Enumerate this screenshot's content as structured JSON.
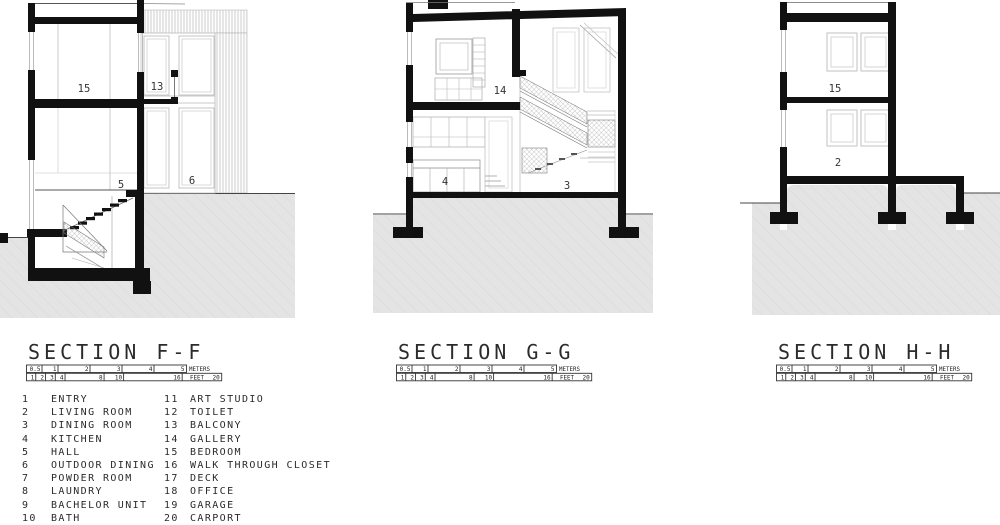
{
  "colors": {
    "ink": "#111111",
    "ground": "#e4e4e4",
    "ground_hatch": "#d8d8d8",
    "thin_line": "#9a9a9a",
    "frame": "#bbbbbb",
    "text": "#2b2b2b"
  },
  "sections": [
    {
      "id": "ff",
      "title": "SECTION F-F",
      "labels": {
        "bedroom": "15",
        "balcony": "13",
        "hall": "5",
        "outdoor_dining": "6"
      }
    },
    {
      "id": "gg",
      "title": "SECTION G-G",
      "labels": {
        "gallery": "14",
        "kitchen": "4",
        "dining_room": "3"
      }
    },
    {
      "id": "hh",
      "title": "SECTION H-H",
      "labels": {
        "bedroom": "15",
        "living_room": "2"
      }
    }
  ],
  "scalebar": {
    "meters_unit": "METERS",
    "feet_unit": "FEET",
    "meters": [
      0.5,
      1,
      2,
      3,
      4,
      5
    ],
    "feet": [
      1,
      2,
      3,
      4,
      8,
      10,
      16,
      20
    ]
  },
  "legend": {
    "left": [
      {
        "num": "1",
        "name": "ENTRY"
      },
      {
        "num": "2",
        "name": "LIVING ROOM"
      },
      {
        "num": "3",
        "name": "DINING ROOM"
      },
      {
        "num": "4",
        "name": "KITCHEN"
      },
      {
        "num": "5",
        "name": "HALL"
      },
      {
        "num": "6",
        "name": "OUTDOOR DINING"
      },
      {
        "num": "7",
        "name": "POWDER ROOM"
      },
      {
        "num": "8",
        "name": "LAUNDRY"
      },
      {
        "num": "9",
        "name": "BACHELOR UNIT"
      },
      {
        "num": "10",
        "name": "BATH"
      }
    ],
    "right": [
      {
        "num": "11",
        "name": "ART STUDIO"
      },
      {
        "num": "12",
        "name": "TOILET"
      },
      {
        "num": "13",
        "name": "BALCONY"
      },
      {
        "num": "14",
        "name": "GALLERY"
      },
      {
        "num": "15",
        "name": "BEDROOM"
      },
      {
        "num": "16",
        "name": "WALK THROUGH CLOSET"
      },
      {
        "num": "17",
        "name": "DECK"
      },
      {
        "num": "18",
        "name": "OFFICE"
      },
      {
        "num": "19",
        "name": "GARAGE"
      },
      {
        "num": "20",
        "name": "CARPORT"
      }
    ]
  }
}
